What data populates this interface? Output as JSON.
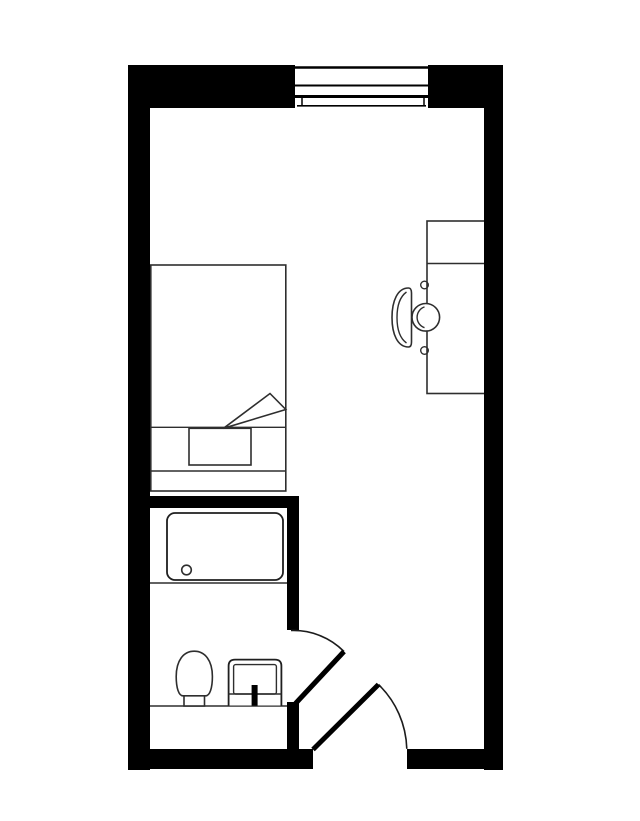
{
  "app": {
    "aria_label": "Floor plan of a studio room with en-suite bathroom"
  },
  "colors": {
    "wall": "#000000",
    "floor": "#ffffff",
    "fixture_line": "#2e2e2e"
  },
  "plan": {
    "rooms": [
      {
        "id": "main-room",
        "label": "Main room"
      },
      {
        "id": "bathroom",
        "label": "Bathroom"
      }
    ],
    "fixtures": [
      {
        "id": "window",
        "label": "Window in top exterior wall"
      },
      {
        "id": "bed",
        "label": "Bed with pillow and folded-back blanket corner"
      },
      {
        "id": "desk",
        "label": "Desk against right wall"
      },
      {
        "id": "desk-chair",
        "label": "Desk chair with backrest and round seat"
      },
      {
        "id": "bathtub",
        "label": "Bathtub with drain"
      },
      {
        "id": "toilet",
        "label": "Toilet"
      },
      {
        "id": "sink",
        "label": "Sink with faucet"
      },
      {
        "id": "vanity-edge",
        "label": "Bathroom counter edge line"
      },
      {
        "id": "tub-deck-edge",
        "label": "Tub deck edge line"
      }
    ],
    "doors": [
      {
        "id": "bathroom-door",
        "label": "Bathroom door with swing arc"
      },
      {
        "id": "entry-door",
        "label": "Entry door with swing arc"
      }
    ]
  }
}
